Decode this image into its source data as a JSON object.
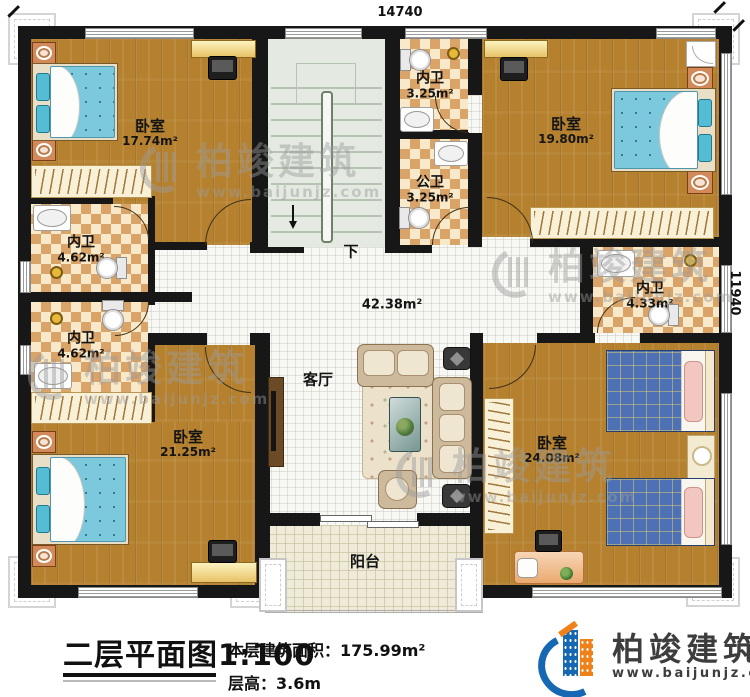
{
  "dimensions": {
    "width_top": "14740",
    "height_right": "11940"
  },
  "watermark": {
    "brand": "柏竣建筑",
    "url": "www.baijunjz.com"
  },
  "rooms": {
    "bedroom_top_left": {
      "name": "卧室",
      "area": "17.74m²"
    },
    "bedroom_top_right": {
      "name": "卧室",
      "area": "19.80m²"
    },
    "bedroom_bottom_left": {
      "name": "卧室",
      "area": "21.25m²"
    },
    "bedroom_bottom_right": {
      "name": "卧室",
      "area": "24.08m²"
    },
    "ensuite_top": {
      "name": "内卫",
      "area": "3.25m²"
    },
    "public_bath": {
      "name": "公卫",
      "area": "3.25m²"
    },
    "ensuite_left_upper": {
      "name": "内卫",
      "area": "4.62m²"
    },
    "ensuite_left_lower": {
      "name": "内卫",
      "area": "4.62m²"
    },
    "ensuite_right": {
      "name": "内卫",
      "area": "4.33m²"
    },
    "living_room": {
      "name": "客厅",
      "area": "42.38m²"
    },
    "balcony": {
      "name": "阳台"
    },
    "stairs": {
      "direction_label": "下"
    }
  },
  "footer": {
    "plan_title": "二层平面图",
    "plan_scale": "1:100",
    "floor_area_label": "本层建筑面积：",
    "floor_area_value": "175.99m²",
    "floor_height_label": "层高：",
    "floor_height_value": "3.6m",
    "brand_name": "柏竣建筑",
    "brand_url": "www.baijunjz.com"
  },
  "colors": {
    "wall": "#171717",
    "wood_floor": "#b5812f",
    "tile_light": "#f7e9c9",
    "tile_dark": "#daa469",
    "living_floor": "#f8f8f4",
    "balcony_floor": "#efebd8",
    "stairs_floor": "#e4eae1",
    "bed_blue": "#7cc8dd",
    "twin_bed_blue": "#4d71b4",
    "brand_blue": "#1768b3",
    "brand_orange": "#f08119"
  }
}
